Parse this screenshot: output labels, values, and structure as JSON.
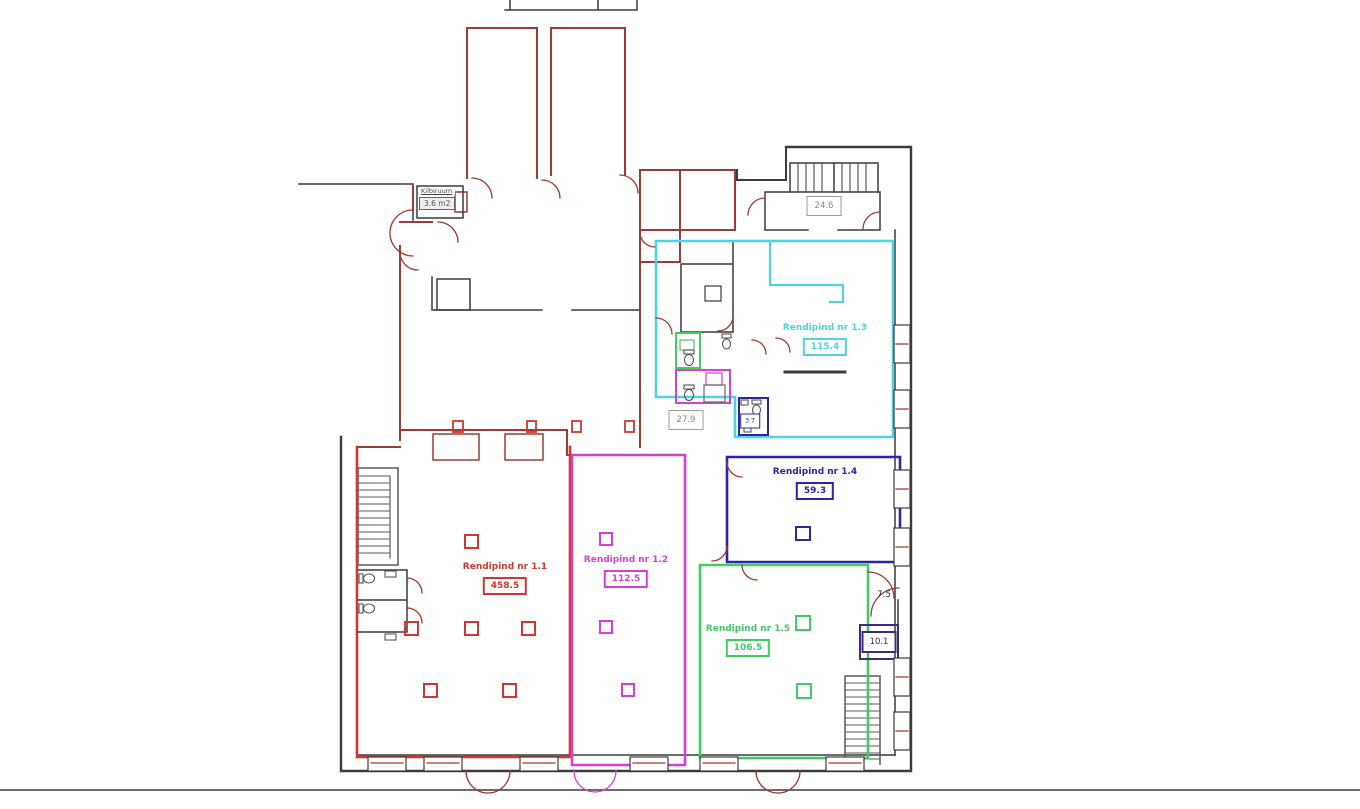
{
  "title": "Floor plan with rental areas",
  "rooms": [
    {
      "id": "1.1",
      "label": "Rendipind nr 1.1",
      "area": "458.5",
      "color_key": "r11"
    },
    {
      "id": "1.2",
      "label": "Rendipind nr 1.2",
      "area": "112.5",
      "color_key": "r12"
    },
    {
      "id": "1.3",
      "label": "Rendipind nr 1.3",
      "area": "115.4",
      "color_key": "r13"
    },
    {
      "id": "1.4",
      "label": "Rendipind nr 1.4",
      "area": "59.3",
      "color_key": "r14"
    },
    {
      "id": "1.5",
      "label": "Rendipind nr 1.5",
      "area": "106.5",
      "color_key": "r15"
    }
  ],
  "labels": {
    "corridor_area": "24.6",
    "hall_area": "27.9",
    "wc_area": "3.7",
    "stair_room_area": "10.1",
    "vestibule_area": "7.5"
  },
  "kilbiruum": {
    "title": "Kilbiruum",
    "area": "3.6 m2"
  },
  "colors": {
    "wall": "#3b3b3b",
    "redwall": "#9e3b32",
    "r11": "#cf382a",
    "r12": "#d63fd6",
    "r13": "#4fd2e2",
    "r14": "#2c24a9",
    "r15": "#41cb60",
    "graywall": "#5a5a5a",
    "darkbox": "#3d2b7d"
  }
}
